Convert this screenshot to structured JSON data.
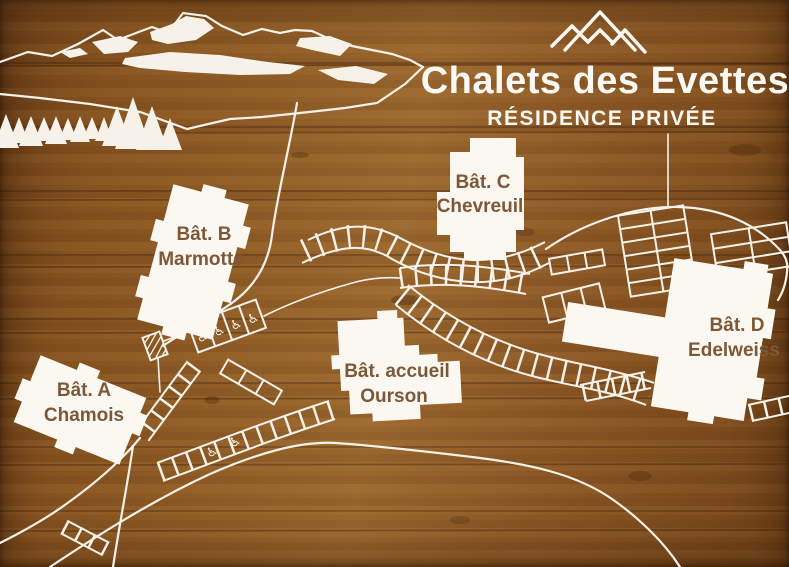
{
  "sign": {
    "title": "Chalets des Evettes",
    "subtitle": "RÉSIDENCE PRIVÉE"
  },
  "buildings": [
    {
      "name": "Bât. A",
      "subname": "Chamois"
    },
    {
      "name": "Bât. B",
      "subname": "Marmotte"
    },
    {
      "name": "Bât. C",
      "subname": "Chevreuil"
    },
    {
      "name": "Bât. D",
      "subname": "Edelweiss"
    },
    {
      "name": "Bât. accueil",
      "subname": "Ourson"
    }
  ],
  "icons": {
    "accessible_parking": "♿",
    "logo": "mountain-peaks"
  },
  "map": {
    "accessible_spaces_marked": 6,
    "decor": [
      "mountain-range",
      "pine-trees",
      "roads",
      "parking-rows"
    ]
  },
  "colors": {
    "wood": "#8a5a2e",
    "line": "#f6f2e9",
    "building_fill": "#fbf8f1",
    "label_text": "#7d5838",
    "title_text": "#fbf9f4"
  }
}
